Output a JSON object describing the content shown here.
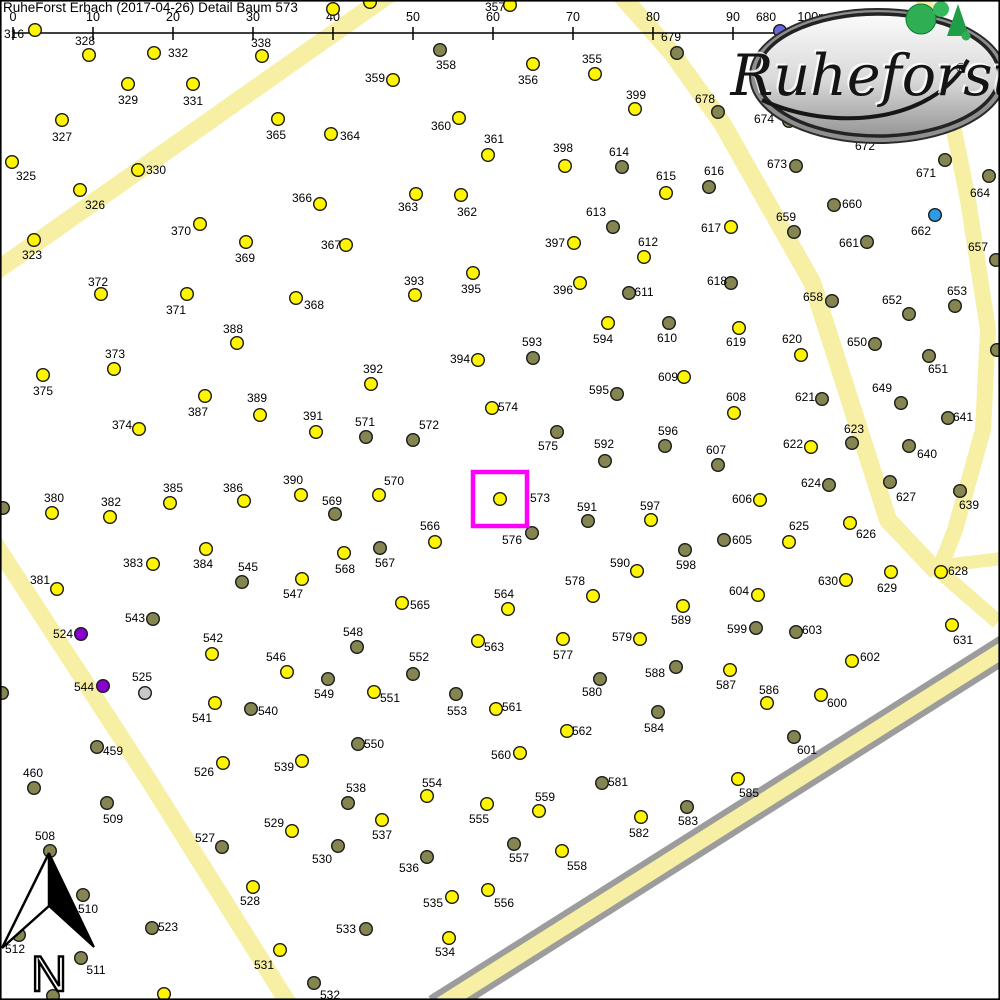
{
  "header": {
    "title": "RuheForst Erbach (2017-04-26) Detail  Baum 573"
  },
  "scale_bar": {
    "ticks": [
      "0",
      "10",
      "20",
      "30",
      "40",
      "50",
      "60",
      "70",
      "80",
      "90",
      "100m"
    ],
    "x_start": 13,
    "spacing": 80,
    "y_line": 33,
    "tick_top": 27,
    "tick_bottom": 40,
    "label_y": 21
  },
  "logo": {
    "text": "Ruheforst",
    "registered": "®"
  },
  "compass": {
    "label": "N"
  },
  "highlight": {
    "tree": "573",
    "x": 473,
    "y": 472,
    "size": 54,
    "color": "#FF00FF",
    "stroke_width": 4.5
  },
  "colors": {
    "background": "#FFFFFF",
    "road": "#F6EFA4",
    "street_border": "#9C9C9C",
    "dot_stroke": "#1A1A1A",
    "y": "#FFF500",
    "d": "#858551",
    "b": "#2F9BE6",
    "v": "#6767DF",
    "p": "#8A00CE",
    "g": "#C8C8C8",
    "frame": "#000000"
  },
  "roads": [
    {
      "id": "path-northwest",
      "pts": [
        [
          398,
          -12
        ],
        [
          -14,
          278
        ]
      ],
      "w": 18
    },
    {
      "id": "path-west",
      "pts": [
        [
          -6,
          542
        ],
        [
          150,
          782
        ],
        [
          290,
          1006
        ]
      ],
      "w": 17
    },
    {
      "id": "path-center",
      "pts": [
        [
          618,
          -8
        ],
        [
          672,
          53
        ],
        [
          722,
          123
        ],
        [
          812,
          282
        ],
        [
          888,
          520
        ],
        [
          937,
          572
        ]
      ],
      "w": 18
    },
    {
      "id": "path-east",
      "pts": [
        [
          922,
          -8
        ],
        [
          948,
          100
        ],
        [
          968,
          200
        ],
        [
          988,
          330
        ],
        [
          983,
          430
        ],
        [
          955,
          530
        ],
        [
          940,
          568
        ]
      ],
      "w": 16
    },
    {
      "id": "path-branch-east",
      "pts": [
        [
          940,
          566
        ],
        [
          1006,
          558
        ]
      ],
      "w": 13
    },
    {
      "id": "path-branch-south",
      "pts": [
        [
          938,
          570
        ],
        [
          998,
          622
        ]
      ],
      "w": 15
    }
  ],
  "street": {
    "id": "street-southeast",
    "pts": [
      [
        436,
        1008
      ],
      [
        1006,
        648
      ]
    ],
    "w_outer": 28,
    "w_inner": 16
  },
  "trees": [
    [
      "316",
      35,
      30,
      "y",
      14,
      34
    ],
    [
      "328",
      89,
      55,
      "y",
      85,
      41
    ],
    [
      "332",
      154,
      53,
      "y",
      178,
      53
    ],
    [
      "338",
      262,
      56,
      "y",
      261,
      43
    ],
    [
      "",
      333,
      9,
      "y",
      null,
      null
    ],
    [
      "",
      370,
      2,
      "y",
      null,
      null
    ],
    [
      "357",
      510,
      5,
      "y",
      495,
      7
    ],
    [
      "358",
      440,
      50,
      "d",
      446,
      65
    ],
    [
      "359",
      393,
      80,
      "y",
      375,
      78
    ],
    [
      "356",
      533,
      64,
      "y",
      528,
      80
    ],
    [
      "355",
      595,
      74,
      "y",
      592,
      59
    ],
    [
      "679",
      677,
      53,
      "d",
      671,
      37
    ],
    [
      "680",
      780,
      31,
      "v",
      766,
      17
    ],
    [
      "399",
      635,
      109,
      "y",
      636,
      95
    ],
    [
      "678",
      718,
      112,
      "d",
      705,
      99
    ],
    [
      "329",
      128,
      84,
      "y",
      128,
      100
    ],
    [
      "331",
      193,
      84,
      "y",
      193,
      101
    ],
    [
      "327",
      62,
      120,
      "y",
      62,
      137
    ],
    [
      "365",
      278,
      119,
      "y",
      276,
      135
    ],
    [
      "364",
      331,
      134,
      "y",
      350,
      136
    ],
    [
      "360",
      459,
      118,
      "y",
      441,
      126
    ],
    [
      "325",
      12,
      162,
      "y",
      26,
      176
    ],
    [
      "330",
      138,
      170,
      "y",
      156,
      170
    ],
    [
      "361",
      488,
      155,
      "y",
      494,
      139
    ],
    [
      "398",
      565,
      166,
      "y",
      563,
      148
    ],
    [
      "614",
      622,
      167,
      "d",
      619,
      152
    ],
    [
      "615",
      666,
      193,
      "y",
      666,
      176
    ],
    [
      "616",
      709,
      187,
      "d",
      714,
      171
    ],
    [
      "366",
      320,
      204,
      "y",
      302,
      198
    ],
    [
      "362",
      461,
      195,
      "y",
      467,
      212
    ],
    [
      "363",
      416,
      194,
      "y",
      408,
      207
    ],
    [
      "326",
      80,
      190,
      "y",
      95,
      205
    ],
    [
      "370",
      200,
      224,
      "y",
      181,
      231
    ],
    [
      "369",
      246,
      242,
      "y",
      245,
      258
    ],
    [
      "323",
      34,
      240,
      "y",
      32,
      255
    ],
    [
      "367",
      346,
      245,
      "y",
      331,
      245
    ],
    [
      "397",
      574,
      243,
      "y",
      555,
      243
    ],
    [
      "613",
      613,
      227,
      "d",
      596,
      212
    ],
    [
      "612",
      644,
      257,
      "y",
      648,
      242
    ],
    [
      "617",
      731,
      227,
      "y",
      711,
      228
    ],
    [
      "660",
      834,
      205,
      "d",
      852,
      204
    ],
    [
      "659",
      794,
      232,
      "d",
      786,
      217
    ],
    [
      "662",
      935,
      215,
      "b",
      921,
      231
    ],
    [
      "661",
      867,
      242,
      "d",
      849,
      243
    ],
    [
      "671",
      945,
      160,
      "d",
      926,
      173
    ],
    [
      "664",
      989,
      176,
      "d",
      980,
      193
    ],
    [
      "672",
      null,
      null,
      null,
      865,
      146
    ],
    [
      "673",
      796,
      166,
      "d",
      777,
      164
    ],
    [
      "674",
      789,
      121,
      "d",
      764,
      119
    ],
    [
      "657",
      996,
      260,
      "d",
      978,
      247
    ],
    [
      "658",
      832,
      301,
      "d",
      813,
      297
    ],
    [
      "618",
      731,
      283,
      "d",
      717,
      281
    ],
    [
      "652",
      909,
      314,
      "d",
      892,
      300
    ],
    [
      "653",
      955,
      306,
      "d",
      957,
      291
    ],
    [
      "650",
      875,
      344,
      "d",
      857,
      342
    ],
    [
      "651",
      929,
      356,
      "d",
      938,
      369
    ],
    [
      "649",
      901,
      403,
      "d",
      882,
      388
    ],
    [
      "641",
      948,
      418,
      "d",
      963,
      417
    ],
    [
      "640",
      909,
      446,
      "d",
      927,
      454
    ],
    [
      "639",
      960,
      491,
      "d",
      969,
      505
    ],
    [
      "627",
      890,
      482,
      "d",
      906,
      497
    ],
    [
      "624",
      829,
      485,
      "d",
      811,
      483
    ],
    [
      "623",
      852,
      443,
      "d",
      854,
      429
    ],
    [
      "622",
      811,
      447,
      "y",
      793,
      444
    ],
    [
      "621",
      822,
      399,
      "d",
      805,
      397
    ],
    [
      "620",
      801,
      355,
      "y",
      792,
      339
    ],
    [
      "619",
      739,
      328,
      "y",
      736,
      342
    ],
    [
      "610",
      669,
      323,
      "d",
      667,
      338
    ],
    [
      "608",
      734,
      413,
      "y",
      736,
      397
    ],
    [
      "609",
      684,
      377,
      "y",
      668,
      377
    ],
    [
      "607",
      718,
      465,
      "d",
      716,
      450
    ],
    [
      "606",
      760,
      500,
      "y",
      742,
      499
    ],
    [
      "605",
      724,
      540,
      "d",
      742,
      540
    ],
    [
      "598",
      685,
      550,
      "d",
      686,
      565
    ],
    [
      "596",
      665,
      446,
      "d",
      668,
      431
    ],
    [
      "597",
      651,
      520,
      "y",
      650,
      506
    ],
    [
      "591",
      588,
      521,
      "d",
      587,
      507
    ],
    [
      "592",
      605,
      461,
      "d",
      604,
      444
    ],
    [
      "595",
      617,
      394,
      "d",
      599,
      390
    ],
    [
      "594",
      608,
      323,
      "y",
      603,
      339
    ],
    [
      "611",
      629,
      293,
      "d",
      644,
      292
    ],
    [
      "593",
      533,
      358,
      "d",
      532,
      342
    ],
    [
      "396",
      580,
      283,
      "y",
      563,
      290
    ],
    [
      "395",
      473,
      273,
      "y",
      471,
      289
    ],
    [
      "393",
      415,
      295,
      "y",
      414,
      281
    ],
    [
      "368",
      296,
      298,
      "y",
      314,
      305
    ],
    [
      "371",
      187,
      294,
      "y",
      176,
      310
    ],
    [
      "372",
      101,
      294,
      "y",
      98,
      282
    ],
    [
      "388",
      237,
      343,
      "y",
      233,
      329
    ],
    [
      "373",
      114,
      369,
      "y",
      115,
      354
    ],
    [
      "375",
      43,
      375,
      "y",
      43,
      391
    ],
    [
      "387",
      205,
      396,
      "y",
      198,
      412
    ],
    [
      "389",
      260,
      415,
      "y",
      257,
      398
    ],
    [
      "391",
      316,
      432,
      "y",
      313,
      416
    ],
    [
      "374",
      139,
      429,
      "y",
      122,
      425
    ],
    [
      "392",
      371,
      384,
      "y",
      373,
      369
    ],
    [
      "394",
      478,
      360,
      "y",
      460,
      359
    ],
    [
      "574",
      492,
      408,
      "y",
      508,
      407
    ],
    [
      "571",
      366,
      437,
      "d",
      365,
      422
    ],
    [
      "572",
      413,
      440,
      "d",
      429,
      425
    ],
    [
      "575",
      557,
      432,
      "d",
      548,
      446
    ],
    [
      "570",
      379,
      495,
      "y",
      394,
      481
    ],
    [
      "573",
      500,
      499,
      "y",
      540,
      498
    ],
    [
      "576",
      532,
      533,
      "d",
      512,
      540
    ],
    [
      "569",
      335,
      514,
      "d",
      332,
      501
    ],
    [
      "385",
      170,
      503,
      "y",
      173,
      488
    ],
    [
      "386",
      244,
      501,
      "y",
      233,
      488
    ],
    [
      "390",
      301,
      495,
      "y",
      293,
      480
    ],
    [
      "380",
      52,
      513,
      "y",
      54,
      498
    ],
    [
      "382",
      110,
      517,
      "y",
      111,
      502
    ],
    [
      "381",
      57,
      589,
      "y",
      40,
      580
    ],
    [
      "383",
      153,
      564,
      "y",
      133,
      563
    ],
    [
      "384",
      206,
      549,
      "y",
      203,
      564
    ],
    [
      "545",
      242,
      582,
      "d",
      248,
      567
    ],
    [
      "547",
      302,
      579,
      "y",
      293,
      594
    ],
    [
      "566",
      435,
      542,
      "y",
      430,
      526
    ],
    [
      "568",
      344,
      553,
      "y",
      345,
      569
    ],
    [
      "567",
      380,
      548,
      "d",
      385,
      563
    ],
    [
      "565",
      402,
      603,
      "y",
      420,
      605
    ],
    [
      "564",
      508,
      609,
      "y",
      504,
      594
    ],
    [
      "590",
      637,
      571,
      "y",
      620,
      563
    ],
    [
      "578",
      593,
      596,
      "y",
      575,
      581
    ],
    [
      "579",
      640,
      639,
      "y",
      622,
      637
    ],
    [
      "577",
      563,
      639,
      "y",
      563,
      655
    ],
    [
      "563",
      478,
      641,
      "y",
      494,
      647
    ],
    [
      "548",
      357,
      647,
      "d",
      353,
      632
    ],
    [
      "543",
      153,
      619,
      "d",
      135,
      618
    ],
    [
      "524",
      81,
      634,
      "p",
      63,
      634
    ],
    [
      "542",
      212,
      654,
      "y",
      213,
      638
    ],
    [
      "546",
      287,
      672,
      "y",
      276,
      657
    ],
    [
      "544",
      103,
      686,
      "p",
      84,
      687
    ],
    [
      "525",
      145,
      693,
      "g",
      142,
      677
    ],
    [
      "549",
      328,
      679,
      "d",
      324,
      694
    ],
    [
      "552",
      413,
      674,
      "d",
      419,
      657
    ],
    [
      "588",
      676,
      667,
      "d",
      655,
      673
    ],
    [
      "580",
      600,
      679,
      "d",
      592,
      692
    ],
    [
      "589",
      683,
      606,
      "y",
      681,
      620
    ],
    [
      "604",
      758,
      595,
      "y",
      739,
      591
    ],
    [
      "599",
      756,
      628,
      "d",
      737,
      629
    ],
    [
      "603",
      796,
      632,
      "d",
      812,
      630
    ],
    [
      "602",
      852,
      661,
      "y",
      870,
      657
    ],
    [
      "600",
      821,
      695,
      "y",
      837,
      703
    ],
    [
      "586",
      767,
      703,
      "y",
      769,
      690
    ],
    [
      "587",
      730,
      670,
      "y",
      726,
      685
    ],
    [
      "601",
      794,
      737,
      "d",
      807,
      750
    ],
    [
      "625",
      789,
      542,
      "y",
      799,
      526
    ],
    [
      "626",
      850,
      523,
      "y",
      866,
      534
    ],
    [
      "630",
      846,
      580,
      "y",
      828,
      581
    ],
    [
      "629",
      891,
      572,
      "y",
      887,
      588
    ],
    [
      "628",
      941,
      572,
      "y",
      958,
      571
    ],
    [
      "631",
      952,
      625,
      "y",
      963,
      640
    ],
    [
      "541",
      215,
      703,
      "y",
      202,
      718
    ],
    [
      "540",
      251,
      709,
      "d",
      268,
      711
    ],
    [
      "551",
      374,
      692,
      "y",
      390,
      698
    ],
    [
      "553",
      456,
      694,
      "d",
      457,
      711
    ],
    [
      "561",
      496,
      709,
      "y",
      512,
      707
    ],
    [
      "562",
      567,
      731,
      "y",
      582,
      731
    ],
    [
      "550",
      358,
      744,
      "d",
      374,
      744
    ],
    [
      "560",
      520,
      753,
      "y",
      501,
      755
    ],
    [
      "584",
      658,
      712,
      "d",
      654,
      728
    ],
    [
      "459",
      97,
      747,
      "d",
      113,
      751
    ],
    [
      "460",
      34,
      788,
      "d",
      33,
      773
    ],
    [
      "509",
      107,
      803,
      "d",
      113,
      819
    ],
    [
      "526",
      223,
      763,
      "y",
      204,
      772
    ],
    [
      "539",
      302,
      761,
      "y",
      284,
      767
    ],
    [
      "508",
      50,
      851,
      "d",
      45,
      836
    ],
    [
      "527",
      222,
      847,
      "d",
      205,
      838
    ],
    [
      "529",
      292,
      831,
      "y",
      274,
      823
    ],
    [
      "530",
      338,
      846,
      "d",
      322,
      859
    ],
    [
      "510",
      83,
      895,
      "d",
      88,
      909
    ],
    [
      "528",
      253,
      887,
      "y",
      250,
      901
    ],
    [
      "523",
      152,
      928,
      "d",
      168,
      927
    ],
    [
      "512",
      19,
      935,
      "d",
      15,
      949
    ],
    [
      "511",
      81,
      958,
      "d",
      96,
      970
    ],
    [
      "531",
      280,
      950,
      "y",
      264,
      965
    ],
    [
      "532",
      314,
      983,
      "d",
      330,
      995
    ],
    [
      "533",
      366,
      929,
      "d",
      346,
      929
    ],
    [
      "534",
      449,
      938,
      "y",
      445,
      952
    ],
    [
      "535",
      452,
      897,
      "y",
      433,
      903
    ],
    [
      "556",
      488,
      890,
      "y",
      504,
      903
    ],
    [
      "536",
      427,
      857,
      "d",
      409,
      868
    ],
    [
      "537",
      382,
      820,
      "y",
      382,
      835
    ],
    [
      "538",
      348,
      803,
      "d",
      356,
      788
    ],
    [
      "554",
      427,
      796,
      "y",
      432,
      783
    ],
    [
      "555",
      487,
      804,
      "y",
      479,
      819
    ],
    [
      "559",
      539,
      811,
      "y",
      545,
      797
    ],
    [
      "557",
      514,
      844,
      "d",
      519,
      858
    ],
    [
      "558",
      562,
      851,
      "y",
      577,
      866
    ],
    [
      "581",
      602,
      783,
      "d",
      618,
      782
    ],
    [
      "582",
      641,
      817,
      "y",
      639,
      833
    ],
    [
      "583",
      687,
      807,
      "d",
      688,
      821
    ],
    [
      "585",
      738,
      779,
      "y",
      749,
      793
    ],
    [
      "",
      997,
      350,
      "d",
      null,
      null
    ],
    [
      "",
      3,
      508,
      "d",
      null,
      null
    ],
    [
      "",
      2,
      693,
      "d",
      null,
      null
    ],
    [
      "",
      53,
      996,
      "d",
      null,
      null
    ],
    [
      "",
      164,
      994,
      "y",
      null,
      null
    ]
  ]
}
